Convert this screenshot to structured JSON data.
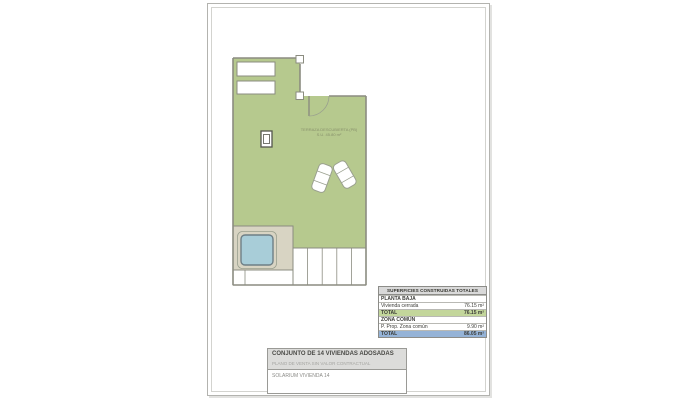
{
  "plan": {
    "terrace_label_line1": "TERRAZA DESCUBIERTA (PB)",
    "terrace_label_line2": "S.U. 45.80 m²",
    "colors": {
      "terrace_green": "#b6c98e",
      "deck_beige": "#d8d4c3",
      "pool_blue": "#a8cdd8",
      "wall_gray": "#8b8c80"
    }
  },
  "areas_table": {
    "title": "SUPERFICIES CONSTRUIDAS TOTALES",
    "rows": [
      {
        "label": "PLANTA BAJA",
        "value": ""
      },
      {
        "label": "Vivienda cerrada",
        "value": "76.15 m²"
      },
      {
        "label": "TOTAL",
        "value": "76.15 m²"
      },
      {
        "label": "ZONA COMÚN",
        "value": ""
      },
      {
        "label": "P. Prop. Zona común",
        "value": "9.90 m²"
      },
      {
        "label": "TOTAL",
        "value": "86.05 m²"
      }
    ],
    "colors": {
      "header_bg": "#d9d9d9",
      "total_green_bg": "#c3d69b",
      "total_blue_bg": "#95b3d7"
    }
  },
  "title_block": {
    "project": "CONJUNTO DE 14 VIVIENDAS ADOSADAS",
    "disclaimer": "PLANO DE VENTA SIN VALOR CONTRACTUAL",
    "drawing": "SOLARIUM VIVIENDA 14"
  }
}
